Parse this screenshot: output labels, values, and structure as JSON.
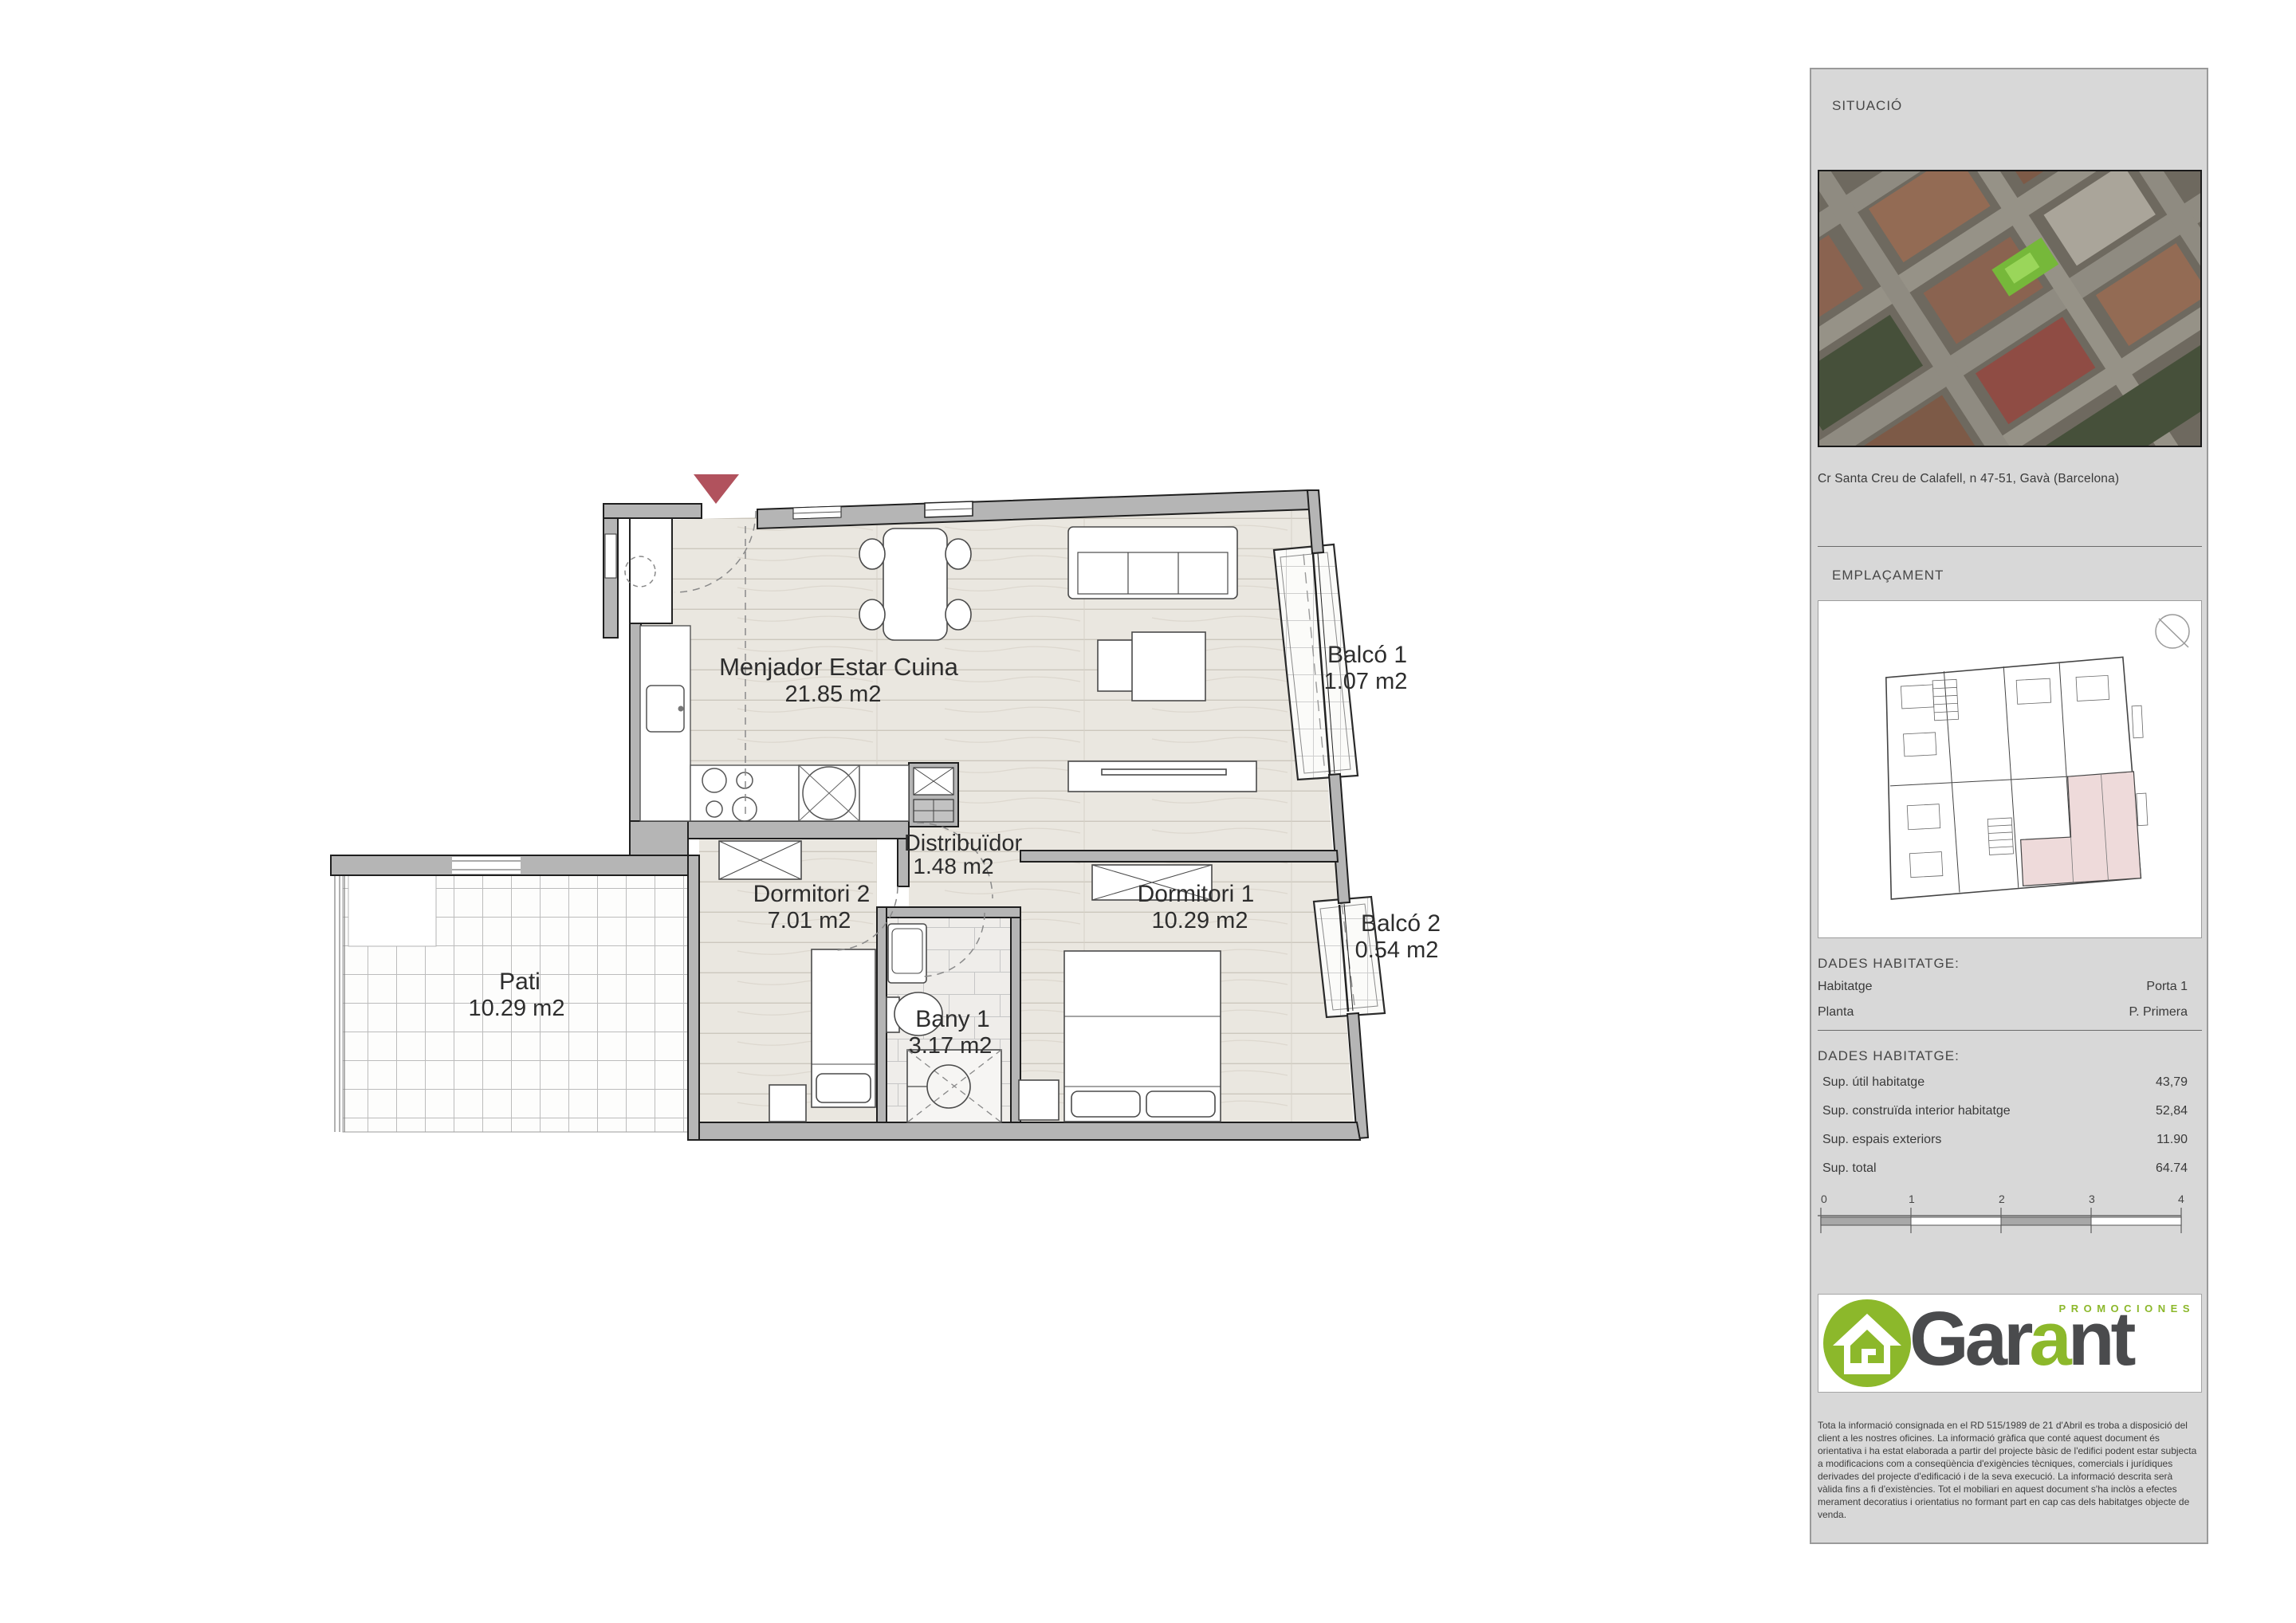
{
  "plan": {
    "entry_marker_color": "#b1525d",
    "rooms": [
      {
        "label": "Menjador Estar Cuina",
        "area": "21.85 m2"
      },
      {
        "label": "Distribuïdor",
        "area": "1.48 m2"
      },
      {
        "label": "Dormitori 2",
        "area": "7.01 m2"
      },
      {
        "label": "Dormitori 1",
        "area": "10.29 m2"
      },
      {
        "label": "Bany 1",
        "area": "3.17 m2"
      },
      {
        "label": "Pati",
        "area": "10.29 m2"
      },
      {
        "label": "Balcó 1",
        "area": "1.07 m2"
      },
      {
        "label": "Balcó 2",
        "area": "0.54 m2"
      }
    ]
  },
  "sidebar": {
    "situacio_title": "SITUACIÓ",
    "address": "Cr Santa Creu de Calafell, n 47-51, Gavà (Barcelona)",
    "emplacament_title": "EMPLAÇAMENT",
    "dades_title_1": "DADES HABITATGE:",
    "info_rows": [
      {
        "label": "Habitatge",
        "value": "Porta 1"
      },
      {
        "label": "Planta",
        "value": "P. Primera"
      }
    ],
    "dades_title_2": "DADES HABITATGE:",
    "area_rows": [
      {
        "label": "Sup. útil habitatge",
        "value": "43,79"
      },
      {
        "label": "Sup. construïda interior habitatge",
        "value": "52,84"
      },
      {
        "label": "Sup. espais exteriors",
        "value": "11.90"
      },
      {
        "label": "Sup. total",
        "value": "64.74"
      }
    ],
    "scale_ticks": [
      "0",
      "1",
      "2",
      "3",
      "4"
    ],
    "logo": {
      "brand_part1": "Gar",
      "brand_part2": "a",
      "brand_part3": "nt",
      "tagline": "PROMOCIONES",
      "green": "#8cb82b",
      "dark": "#4a4b4d"
    },
    "disclaimer": "Tota la informació consignada en el RD 515/1989 de 21 d'Abril es troba a disposició del client a les nostres oficines. La informació gràfica que conté aquest document és orientativa i ha estat elaborada a partir del projecte bàsic de l'edifici podent estar subjecta a modificacions com a conseqüència d'exigències tècniques, comercials i jurídiques derivades del projecte d'edificació i de la seva execució. La informació descrita serà vàlida fins a fi d'existències. Tot el mobiliari en aquest document s'ha inclòs a efectes merament decoratius i orientatius no formant part en cap cas dels habitatges objecte de venda."
  }
}
